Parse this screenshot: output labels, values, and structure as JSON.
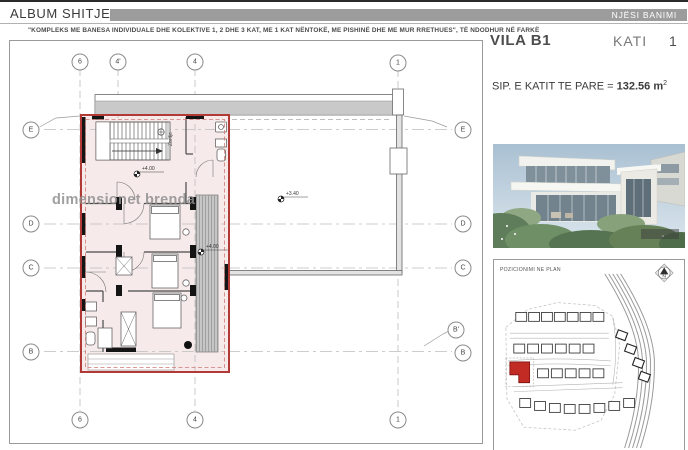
{
  "header": {
    "title": "ALBUM SHITJESH",
    "badge": "NJËSI BANIMI"
  },
  "subtitle": "\"KOMPLEKS ME BANESA INDIVIDUALE DHE KOLEKTIVE 1, 2 DHE 3 KAT, ME 1 KAT NËNTOKË, ME PISHINË DHE ME MUR RRETHUES\", TË NDODHUR NË FARKË",
  "unit_panel": {
    "name": "VILA B1",
    "floor_label": "KATI",
    "floor_value": "1",
    "area_label": "SIP. E KATIT TE PARE = ",
    "area_value": "132.56 m",
    "area_exponent": "2"
  },
  "plan": {
    "watermark": "dimensionet brenda",
    "stair_label": "Zbritje",
    "elevations": {
      "stair": "+4.00",
      "terrace": "+3.40",
      "balcony": "+4.00"
    },
    "grid_top": [
      "6",
      "4'",
      "4",
      "1"
    ],
    "grid_bottom": [
      "6",
      "4",
      "1"
    ],
    "grid_left": [
      "E",
      "D",
      "C",
      "B"
    ],
    "grid_right": [
      "E",
      "D",
      "C",
      "B'",
      "B"
    ]
  },
  "siteplan": {
    "title": "POZICIONIMI NE PLAN",
    "north_label": "N"
  },
  "colors": {
    "accent_red": "#b23a36",
    "badge_grey": "#9c9c9c",
    "plan_pink": "#f7eaea",
    "site_red": "#c22a24"
  }
}
